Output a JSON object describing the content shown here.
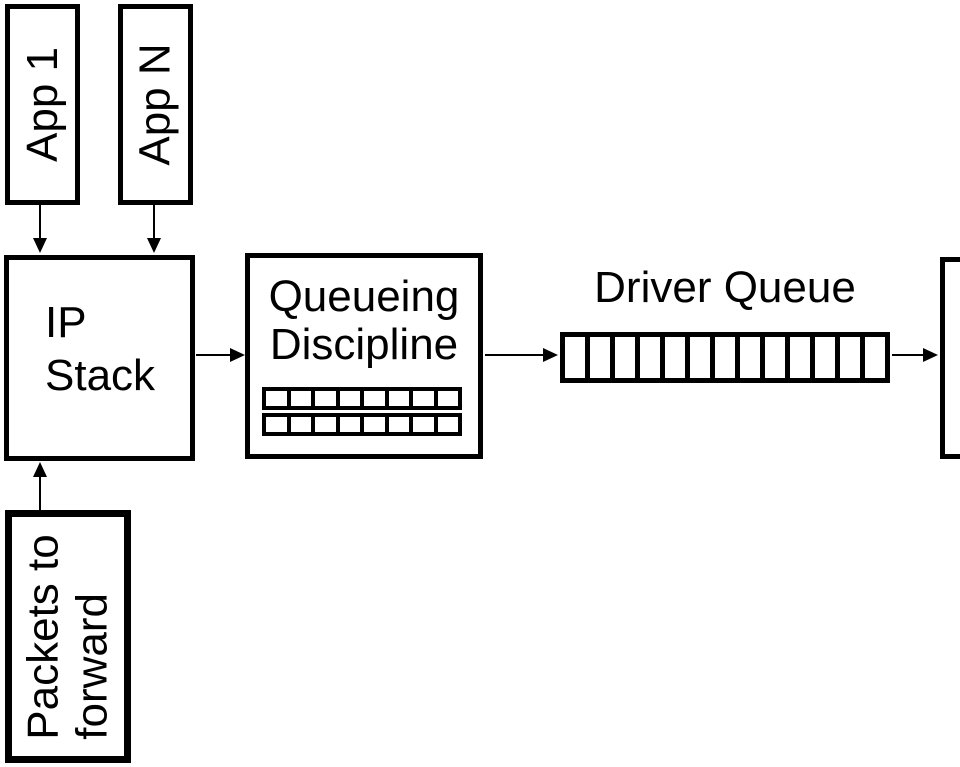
{
  "colors": {
    "background": "#ffffff",
    "line": "#000000",
    "text": "#000000"
  },
  "nodes": {
    "app1": {
      "label": "App 1"
    },
    "appN": {
      "label": "App N"
    },
    "ip_stack": {
      "line1": "IP",
      "line2": "Stack"
    },
    "queueing_discipline": {
      "line1": "Queueing",
      "line2": "Discipline",
      "rows": 2,
      "cells_per_row": 8
    },
    "driver_queue": {
      "label": "Driver Queue",
      "cells": 13
    },
    "packets_to_forward": {
      "line1": "Packets to",
      "line2": "forward"
    }
  },
  "edges": [
    {
      "from": "app1",
      "to": "ip_stack"
    },
    {
      "from": "appN",
      "to": "ip_stack"
    },
    {
      "from": "packets_to_forward",
      "to": "ip_stack"
    },
    {
      "from": "ip_stack",
      "to": "queueing_discipline"
    },
    {
      "from": "queueing_discipline",
      "to": "driver_queue"
    },
    {
      "from": "driver_queue",
      "to": "nic"
    }
  ]
}
